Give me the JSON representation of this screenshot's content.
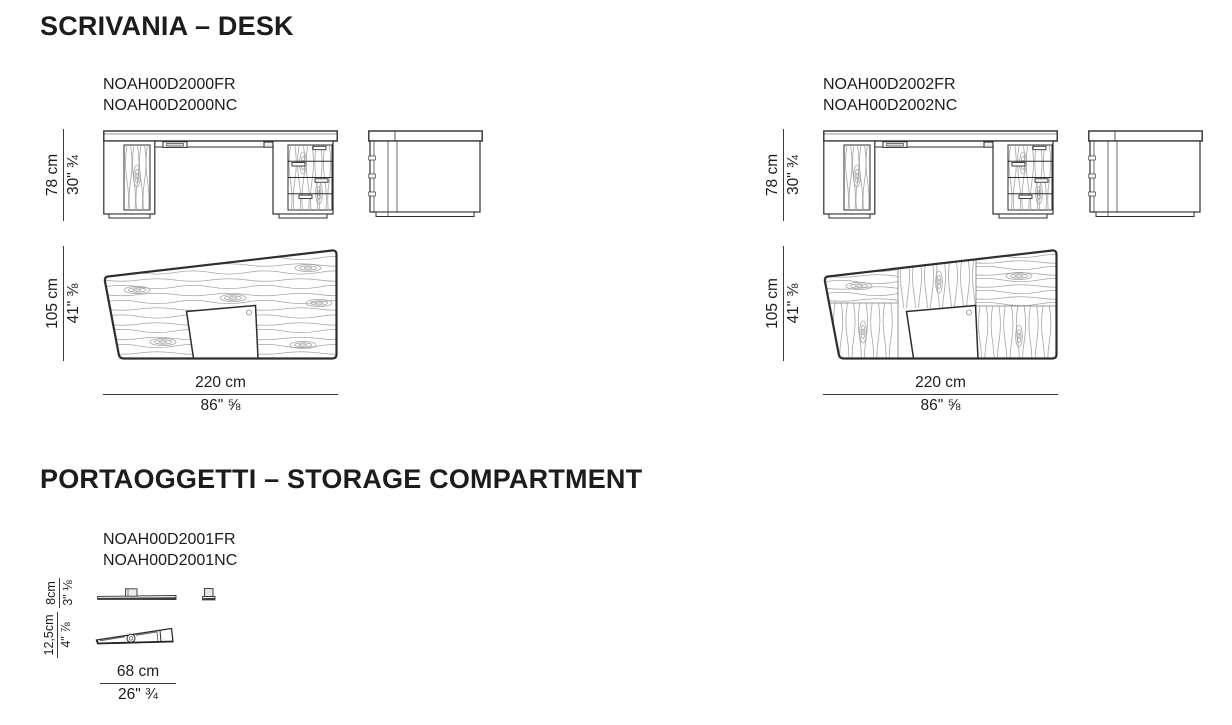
{
  "sections": {
    "desk": {
      "title": "SCRIVANIA – DESK",
      "products": {
        "d2000": {
          "code_fr": "NOAH00D2000FR",
          "code_nc": "NOAH00D2000NC",
          "height": {
            "cm": "78 cm",
            "in": "30\" ¾"
          },
          "depth": {
            "cm": "105 cm",
            "in": "41\" ⅜"
          },
          "width": {
            "cm": "220 cm",
            "in": "86\" ⅝"
          }
        },
        "d2002": {
          "code_fr": "NOAH00D2002FR",
          "code_nc": "NOAH00D2002NC",
          "height": {
            "cm": "78 cm",
            "in": "30\" ¾"
          },
          "depth": {
            "cm": "105 cm",
            "in": "41\" ⅜"
          },
          "width": {
            "cm": "220 cm",
            "in": "86\" ⅝"
          }
        }
      }
    },
    "storage": {
      "title": "PORTAOGGETTI – STORAGE COMPARTMENT",
      "products": {
        "d2001": {
          "code_fr": "NOAH00D2001FR",
          "code_nc": "NOAH00D2001NC",
          "height": {
            "cm": "8cm",
            "in": "3\" ⅛"
          },
          "depth": {
            "cm": "12,5cm",
            "in": "4\" ⅞"
          },
          "width": {
            "cm": "68 cm",
            "in": "26\" ¾"
          }
        }
      }
    }
  },
  "colors": {
    "ink": "#1c1c1c",
    "line": "#2e2e2e",
    "grain": "#a6a6a6",
    "background": "#ffffff"
  }
}
